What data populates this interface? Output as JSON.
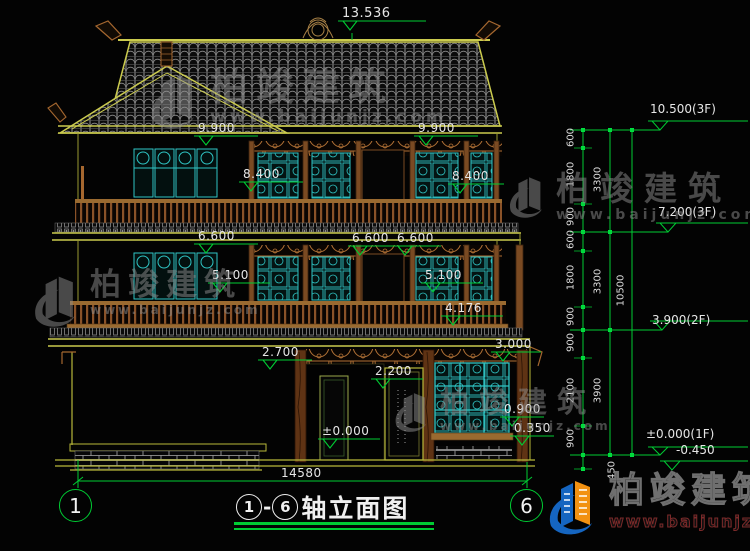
{
  "meta": {
    "title_axis_start": "1",
    "title_sep": "-",
    "title_axis_end": "6",
    "title_name": "轴立面图"
  },
  "marks": {
    "top": "13.536",
    "f9900": "9.900",
    "f8400": "8.400",
    "f6600": "6.600",
    "f5100": "5.100",
    "f4176": "4.176",
    "f3000": "3.000",
    "f2700": "2.700",
    "f2200": "2.200",
    "f0900": "0.900",
    "f0350": "0.350",
    "f0000": "±0.000"
  },
  "right_levels": {
    "roof": "10.500(3F)",
    "third": "7.200(3F)",
    "second": "3.900(2F)",
    "first": "±0.000(1F)",
    "below": "-0.450"
  },
  "segs": {
    "s600": "600",
    "s900": "900",
    "s1800": "1800",
    "s2100": "2100",
    "s3300": "3300",
    "s3900": "3900",
    "s10500": "10500",
    "s450": "450"
  },
  "bottom": {
    "width_dim": "14580",
    "axis_left": "1",
    "axis_right": "6"
  },
  "watermark": {
    "brand": "柏竣建筑",
    "site": "www.baijunjz.com"
  },
  "colors": {
    "dim_green": "#00cc33",
    "line_yellow": "#c8c83c",
    "wood_brown": "#a5672f",
    "lattice_cyan": "#2fc4c4",
    "logo_blue": "#1565c0",
    "logo_orange": "#f29111"
  }
}
